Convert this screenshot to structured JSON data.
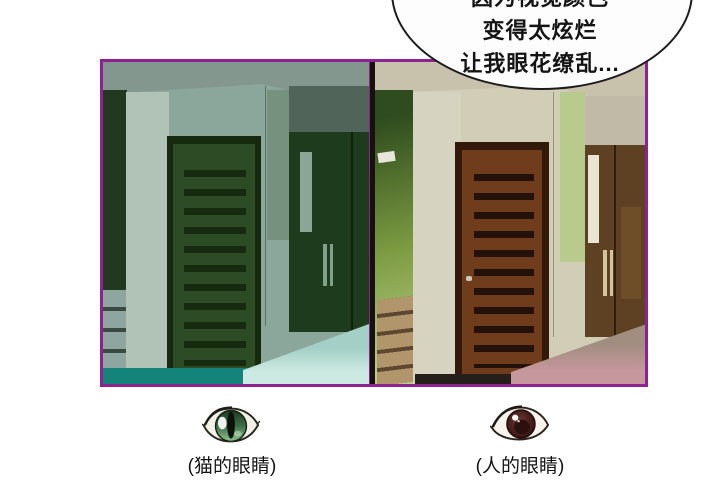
{
  "speech_bubble": {
    "lines": [
      "因为视觉颜色",
      "变得太炫烂",
      "让我眼花缭乱..."
    ]
  },
  "panels": {
    "cat_vision": {
      "caption": "(猫的眼睛)",
      "icon": "cat-eye-icon"
    },
    "human_vision": {
      "caption": "(人的眼睛)",
      "icon": "human-eye-icon"
    }
  },
  "colors": {
    "panel_border": "#8e2292",
    "bubble_outline": "#1c1c1c",
    "text_color": "#141414",
    "cat_wall": "#8ba69a",
    "cat_ceiling": "#83978f",
    "cat_left_wall": "#22391f",
    "cat_column": "#b1c2b6",
    "cat_door_frame": "#172a10",
    "cat_door": "#2d4b25",
    "cat_slat": "#152a0e",
    "cat_band": "#50645a",
    "cat_strip": "#76927e",
    "cat_corner": "#5d7265",
    "cat_wardrobe": "#1e3b1e",
    "cat_ward_hl": "#8ba694",
    "cat_handle": "#7fa089",
    "cat_drawer": "#8fa6a0",
    "cat_drawer_gap": "#394a40",
    "cat_bed_top": "#a3cfc6",
    "cat_bed_front": "#cdeae2",
    "cat_floor": "#14847b",
    "hum_wall": "#d2cdb7",
    "hum_ceiling": "#c8c1ab",
    "hum_green_dark": "#2e4c1d",
    "hum_green": "#7d9c42",
    "hum_green_hl": "#bccf86",
    "hum_column": "#d7d3c1",
    "hum_door_frame": "#33190b",
    "hum_door": "#6f3c1c",
    "hum_slat": "#24110a",
    "hum_band": "#c1baa6",
    "hum_green_strip": "#b9cb8c",
    "hum_corner": "#96917b",
    "hum_wardrobe": "#5e4022",
    "hum_ward_dk": "#311d0e",
    "hum_handle": "#e9e4d3",
    "hum_handle2": "#d3c59b",
    "hum_drawer": "#b2966b",
    "hum_drawer_gap": "#5e4730",
    "hum_bed_top": "#a28e81",
    "hum_bed_front": "#c6979d",
    "hum_floor": "#241f1a"
  }
}
